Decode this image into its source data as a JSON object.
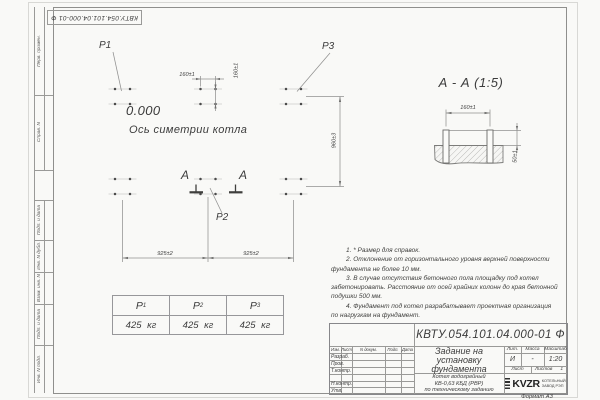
{
  "sheet": {
    "doc_number": "КВТУ.054.101.04.000-01 Ф",
    "format_label": "Формат А3",
    "sidebar_labels": [
      "Перв. примен.",
      "Справ. N",
      "Подп. и дата",
      "Инв. N дубл.",
      "Взам. инв. N",
      "Подп. и дата",
      "Инв. N подл."
    ]
  },
  "plan": {
    "level_mark": "0.000",
    "axis_label": "Ось симетрии котла",
    "point_labels": [
      "P1",
      "P2",
      "P3"
    ],
    "section_letter": "А",
    "dim_bolt_spacing_x": "160±1",
    "dim_bolt_spacing_y": "160±1",
    "dim_span_left": "925±2",
    "dim_span_right": "925±2",
    "dim_depth": "960±3"
  },
  "section_view": {
    "title": "А - А (1:5)",
    "dim_bolt_spacing": "160±1",
    "dim_protrusion": "50±1"
  },
  "load_table": {
    "columns": [
      {
        "symbol": "P",
        "sub": "1",
        "value": "425 кг"
      },
      {
        "symbol": "P",
        "sub": "2",
        "value": "425 кг"
      },
      {
        "symbol": "P",
        "sub": "3",
        "value": "425 кг"
      }
    ]
  },
  "notes": {
    "lines": [
      "1. * Размер для справок.",
      "2. Отклонение от горизонтального уровня верхней поверхности",
      "фундамента не более 10 мм.",
      "3. В случае отсутствия бетонного пола площадку под котел",
      "забетонировать. Расстояние от осей крайних колонн до края бетонной",
      "подушки 500 мм.",
      "4. Фундамент под котел разрабатывает проектная организация",
      "по нагрузкам на фундамент."
    ]
  },
  "title_block": {
    "doc_number": "КВТУ.054.101.04.000-01 Ф",
    "title_lines": [
      "Задание на",
      "установку",
      "фундамента"
    ],
    "subtitle_lines": [
      "Котел водогрейный",
      "КВ-0,63 КБД (РВР)",
      "по техническому заданию"
    ],
    "header_cells": [
      "Изм.",
      "Лист",
      "N докум.",
      "Подп.",
      "Дата"
    ],
    "row_labels": [
      "Разраб.",
      "Пров.",
      "Т.контр.",
      "Н.контр.",
      "Утв."
    ],
    "lit_label": "Лит.",
    "mass_label": "Масса",
    "scale_label": "Масштаб",
    "lit_value": "И",
    "mass_value": "-",
    "scale_value": "1:20",
    "sheet_label": "Лист",
    "sheets_label": "Листов",
    "sheets_value": "1",
    "logo_text": "KVZR",
    "logo_caption": [
      "КОТЕЛЬНЫЙ",
      "ЗАВОД РЭП"
    ]
  }
}
